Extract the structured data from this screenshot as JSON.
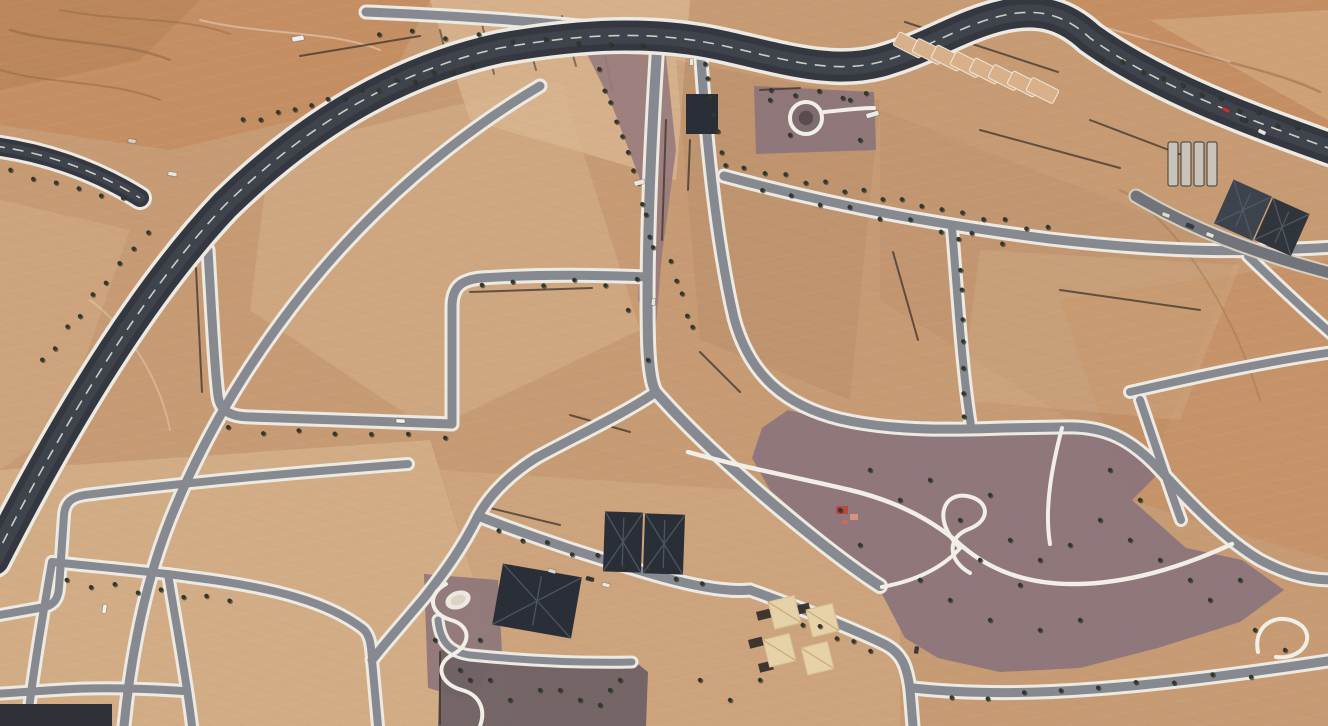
{
  "meta": {
    "description": "Aerial satellite view of a desert residential development: a wide dark asphalt boulevard arcs across the image, gray residential streets with white sidewalks divide empty tan sand plots, mauve landscaped parks with winding white footpaths and small trees fill the southeast, with a few dark-roofed buildings, beige tents and construction traces.",
    "view_type": "satellite-imagery"
  },
  "palette": {
    "sand_base": "#c79a72",
    "sand_light": "#dcba92",
    "sand_pale": "#e8cda6",
    "sand_orange": "#c4804f",
    "sand_dark": "#ae8160",
    "park_mauve": "#8b7379",
    "park_dark": "#6e5f63",
    "median_mauve": "#97797c",
    "asphalt_major": "#31343d",
    "asphalt_wear": "#4a4f59",
    "asphalt_street": "#85888f",
    "asphalt_street_dark": "#6f7278",
    "sidewalk": "#eeebe3",
    "path_white": "#f3f0e8",
    "tree": "#2f3429",
    "roof_dark": "#262a33",
    "roof_ridge": "#505a68",
    "tent": "#e7d2a8",
    "mark_dark": "#8a5f3f",
    "boundary": "#3a3028"
  },
  "patches": [
    {
      "points": "0,0 430,0 380,100 170,150 0,125",
      "fill": "sand_orange",
      "opacity": 0.5
    },
    {
      "points": "0,0 200,0 140,60 0,90",
      "fill": "#a97848",
      "opacity": 0.35
    },
    {
      "points": "430,0 690,0 676,180 470,120",
      "fill": "sand_pale",
      "opacity": 0.45
    },
    {
      "points": "1010,0 1328,0 1328,160 1090,50",
      "fill": "sand_orange",
      "opacity": 0.5
    },
    {
      "points": "1150,20 1328,10 1328,120",
      "fill": "sand_pale",
      "opacity": 0.3
    },
    {
      "points": "270,150 560,80 640,330 430,430 250,310",
      "fill": "sand_light",
      "opacity": 0.4
    },
    {
      "points": "676,60 880,100 850,400 700,340",
      "fill": "sand_dark",
      "opacity": 0.28
    },
    {
      "points": "880,110 1240,250 1150,470 880,300",
      "fill": "sand_dark",
      "opacity": 0.18
    },
    {
      "points": "1060,300 1328,260 1328,560 1130,500",
      "fill": "sand_orange",
      "opacity": 0.3
    },
    {
      "points": "0,470 430,440 520,726 0,726",
      "fill": "sand_pale",
      "opacity": 0.35
    },
    {
      "points": "440,470 900,500 900,726 520,726",
      "fill": "sand_light",
      "opacity": 0.3
    },
    {
      "points": "0,200 130,230 60,430 0,470",
      "fill": "sand_light",
      "opacity": 0.3
    },
    {
      "points": "980,250 1240,265 1180,420 960,400",
      "fill": "sand_light",
      "opacity": 0.25
    }
  ],
  "terrain_marks": [
    {
      "d": "M 10,30 C 60,45 120,40 170,60",
      "color": "mark_dark",
      "width": 2.5,
      "opacity": 0.5
    },
    {
      "d": "M 0,70 C 50,85 110,80 160,100",
      "color": "mark_dark",
      "width": 2,
      "opacity": 0.45
    },
    {
      "d": "M 60,10 C 120,22 180,16 230,34",
      "color": "mark_dark",
      "width": 2,
      "opacity": 0.4
    },
    {
      "d": "M 200,20 C 260,35 330,30 380,50",
      "color": "#f0e4d2",
      "width": 2,
      "opacity": 0.45
    },
    {
      "d": "M 380,95 C 480,62 580,42 660,42",
      "color": "boundary",
      "width": 2,
      "opacity": 0.6
    },
    {
      "d": "M 440,30 L 452,80",
      "color": "boundary",
      "width": 2,
      "opacity": 0.55
    },
    {
      "d": "M 482,24 L 494,74",
      "color": "boundary",
      "width": 2,
      "opacity": 0.55
    },
    {
      "d": "M 522,20 L 536,70",
      "color": "boundary",
      "width": 2,
      "opacity": 0.55
    },
    {
      "d": "M 562,16 L 576,66",
      "color": "boundary",
      "width": 2,
      "opacity": 0.55
    },
    {
      "d": "M 602,40 L 612,90",
      "color": "boundary",
      "width": 2,
      "opacity": 0.55
    },
    {
      "d": "M 1150,40 C 1220,62 1280,72 1320,92",
      "color": "mark_dark",
      "width": 2.5,
      "opacity": 0.45
    },
    {
      "d": "M 1080,20 C 1130,36 1180,46 1230,62",
      "color": "#f0e4d2",
      "width": 2,
      "opacity": 0.4
    },
    {
      "d": "M 1120,190 C 1170,215 1230,300 1260,400",
      "color": "mark_dark",
      "width": 2,
      "opacity": 0.3
    },
    {
      "d": "M 90,300 C 130,330 160,380 170,430",
      "color": "#f0e4d2",
      "width": 2,
      "opacity": 0.35
    }
  ],
  "parks": [
    {
      "name": "center-median",
      "points": "586,52 666,56 676,150 662,255 655,335 638,300 644,190 610,100",
      "fill": "median_mauve",
      "opacity": 0.9
    },
    {
      "name": "roundabout-plot",
      "points": "754,86 874,92 876,150 756,154",
      "fill": "park_mauve",
      "opacity": 0.95
    },
    {
      "name": "southeast-park",
      "points": "788,410 852,426 952,434 1062,428 1108,436 1160,472 1132,500 1186,548 1242,560 1284,590 1240,622 1158,648 1080,668 1000,672 938,658 905,638 880,590 828,540 770,490 752,458 762,428",
      "fill": "park_mauve",
      "opacity": 0.95
    },
    {
      "name": "pond-park",
      "points": "424,574 498,580 502,652 470,700 428,688",
      "fill": "park_mauve",
      "opacity": 0.9
    },
    {
      "name": "courtyard",
      "points": "440,650 630,658 648,672 646,726 438,726",
      "fill": "park_dark",
      "opacity": 0.95
    }
  ],
  "roads_major": [
    {
      "name": "main-boulevard",
      "d": "M -6,560 C 60,430 140,295 225,205 C 310,122 400,70 500,48 C 580,34 650,30 720,45 C 780,58 830,75 880,62 C 930,48 960,25 1005,15 C 1040,8 1065,15 1090,38 C 1160,88 1250,120 1334,150",
      "width": 30,
      "casing": 37,
      "dash": true
    },
    {
      "name": "west-access-road",
      "d": "M -6,146 C 40,152 92,168 140,198",
      "width": 18,
      "casing": 24,
      "dash": true
    }
  ],
  "roads_minor": [
    {
      "name": "northeast-service-road",
      "d": "M 1136,196 C 1190,228 1250,252 1334,274",
      "width": 11,
      "casing": 15
    }
  ],
  "streets": [
    {
      "name": "top-street",
      "d": "M 366,12 C 470,16 570,24 658,34",
      "w": 9
    },
    {
      "name": "central-vertical",
      "d": "M 658,34 C 651,140 646,250 648,340 C 649,370 652,386 656,392",
      "w": 10
    },
    {
      "name": "southeast-diagonal",
      "d": "M 656,392 C 684,424 722,460 766,498 C 812,537 852,568 880,586",
      "w": 10
    },
    {
      "name": "southwest-diagonal",
      "d": "M 656,392 C 624,414 576,436 536,458 C 506,477 488,498 478,516",
      "w": 9
    },
    {
      "name": "southwest-continuation",
      "d": "M 478,516 C 462,548 444,573 424,598 C 404,622 386,642 372,660",
      "w": 9
    },
    {
      "name": "below-villas",
      "d": "M 478,516 C 540,540 602,560 662,577 C 702,588 732,592 750,590",
      "w": 9
    },
    {
      "name": "tents-wrap",
      "d": "M 750,590 C 800,608 850,628 882,643 C 902,652 907,666 910,690 L 913,726",
      "w": 9
    },
    {
      "name": "park-south-street",
      "d": "M 913,688 C 1020,700 1150,688 1334,660",
      "w": 9
    },
    {
      "name": "median-east-street",
      "d": "M 700,44 C 706,140 716,240 734,318 C 750,378 788,406 840,419 C 892,431 950,430 1004,428 L 1062,427",
      "w": 9
    },
    {
      "name": "park-east-street",
      "d": "M 1062,427 C 1106,425 1132,440 1160,470 C 1192,505 1226,540 1260,560 C 1292,577 1312,580 1334,580",
      "w": 9
    },
    {
      "name": "northeast-mid-street",
      "d": "M 724,176 C 850,210 950,226 1050,239 C 1180,254 1252,252 1334,247",
      "w": 9
    },
    {
      "name": "northeast-vertical",
      "d": "M 952,228 C 958,300 962,370 971,426",
      "w": 8
    },
    {
      "name": "northeast-corner",
      "d": "M 1248,256 C 1285,292 1311,316 1334,336",
      "w": 8
    },
    {
      "name": "east-horizontal",
      "d": "M 1130,392 C 1200,376 1270,361 1334,352",
      "w": 8
    },
    {
      "name": "east-vertical",
      "d": "M 1140,400 C 1155,444 1168,484 1181,520",
      "w": 8
    },
    {
      "name": "inner-arc-street",
      "d": "M 540,86 C 452,138 372,208 307,288 C 247,363 202,440 170,520 C 147,578 132,645 124,726",
      "w": 9
    },
    {
      "name": "northwest-u-street",
      "d": "M 208,250 C 212,320 215,372 218,396 C 220,412 232,417 252,417 L 452,424",
      "w": 9
    },
    {
      "name": "northwest-hook",
      "d": "M 452,424 L 452,307 C 452,286 462,280 481,278 C 540,274 600,275 648,277",
      "w": 9
    },
    {
      "name": "southwest-top-street",
      "d": "M -6,616 L 45,607 C 55,604 58,598 59,588 L 64,515 C 65,502 72,497 85,495 C 190,482 300,472 408,464",
      "w": 8
    },
    {
      "name": "southwest-v1",
      "d": "M 52,562 C 42,620 33,672 27,726",
      "w": 8
    },
    {
      "name": "southwest-h2",
      "d": "M 52,562 C 110,568 165,573 190,577 C 280,588 330,604 362,628 C 370,634 371,645 372,658",
      "w": 8
    },
    {
      "name": "southwest-v4",
      "d": "M 372,660 L 378,726",
      "w": 8
    },
    {
      "name": "southwest-v2",
      "d": "M 168,574 C 176,624 186,676 192,726",
      "w": 8
    },
    {
      "name": "southwest-h3",
      "d": "M -6,694 L 55,690 C 100,687 140,688 183,691",
      "w": 8
    },
    {
      "name": "courtyard-top-lane",
      "d": "M 438,620 C 440,640 448,652 470,655 C 530,661 585,663 632,662",
      "w": 7
    }
  ],
  "paths": [
    {
      "name": "park-main-path",
      "d": "M 688,452 C 745,468 800,478 850,490 C 900,502 935,522 962,546 C 992,572 1030,585 1078,584 C 1128,583 1180,568 1232,544",
      "w": 4.5
    },
    {
      "name": "park-loop-path",
      "d": "M 958,546 C 932,518 944,492 967,496 C 989,500 992,520 969,529 C 947,537 947,560 970,573",
      "w": 4
    },
    {
      "name": "park-north-link",
      "d": "M 1062,428 C 1052,466 1044,508 1050,544",
      "w": 4
    },
    {
      "name": "park-west-link",
      "d": "M 882,587 C 920,580 945,566 962,546",
      "w": 4
    },
    {
      "name": "park-east-blob",
      "d": "M 1258,652 C 1252,622 1282,610 1302,626 C 1316,640 1300,660 1276,657",
      "w": 4
    },
    {
      "name": "pond-path",
      "d": "M 446,584 C 426,595 430,614 451,620 C 472,626 471,645 452,655 C 434,665 440,684 462,690 C 480,695 486,710 480,726",
      "w": 4
    },
    {
      "name": "roundabout-stub",
      "d": "M 824,112 C 845,110 858,108 874,108",
      "w": 4
    }
  ],
  "boundaries": [
    "M 470,292 L 592,288",
    "M 666,120 L 662,240",
    "M 905,22 L 1058,72",
    "M 760,90 L 800,88",
    "M 690,140 L 688,190",
    "M 570,415 L 630,432",
    "M 196,268 L 202,392",
    "M 300,56 L 420,36",
    "M 893,252 L 918,340",
    "M 980,130 L 1120,168",
    "M 1060,290 L 1200,310",
    "M 490,508 L 560,525",
    "M 440,652 L 440,724",
    "M 700,352 L 740,392",
    "M 1090,120 L 1190,158",
    "M 240,418 L 300,420"
  ],
  "tree_lines": [
    [
      240,
      122,
      470,
      66,
      14
    ],
    [
      40,
      362,
      150,
      232,
      9
    ],
    [
      602,
      72,
      654,
      250,
      12
    ],
    [
      668,
      262,
      694,
      330,
      5
    ],
    [
      742,
      168,
      1046,
      230,
      16
    ],
    [
      764,
      190,
      1000,
      242,
      9
    ],
    [
      708,
      62,
      724,
      168,
      7
    ],
    [
      1100,
      56,
      1300,
      130,
      11
    ],
    [
      382,
      32,
      640,
      46,
      9
    ],
    [
      956,
      242,
      966,
      418,
      8
    ],
    [
      12,
      172,
      120,
      200,
      6
    ],
    [
      64,
      582,
      232,
      600,
      8
    ],
    [
      500,
      532,
      700,
      584,
      9
    ],
    [
      952,
      700,
      1250,
      674,
      9
    ],
    [
      800,
      622,
      872,
      650,
      5
    ],
    [
      768,
      92,
      866,
      96,
      5
    ],
    [
      230,
      430,
      445,
      436,
      7
    ],
    [
      480,
      284,
      640,
      282,
      6
    ]
  ],
  "tree_scatter": [
    [
      870,
      470
    ],
    [
      900,
      500
    ],
    [
      930,
      480
    ],
    [
      960,
      520
    ],
    [
      990,
      495
    ],
    [
      1010,
      540
    ],
    [
      1040,
      560
    ],
    [
      1070,
      545
    ],
    [
      1100,
      520
    ],
    [
      1130,
      540
    ],
    [
      1160,
      560
    ],
    [
      1190,
      580
    ],
    [
      1080,
      620
    ],
    [
      1040,
      630
    ],
    [
      990,
      620
    ],
    [
      950,
      600
    ],
    [
      920,
      580
    ],
    [
      1210,
      600
    ],
    [
      1240,
      580
    ],
    [
      860,
      545
    ],
    [
      840,
      510
    ],
    [
      1110,
      470
    ],
    [
      1140,
      500
    ],
    [
      980,
      560
    ],
    [
      1020,
      585
    ],
    [
      1255,
      630
    ],
    [
      1285,
      650
    ],
    [
      700,
      680
    ],
    [
      730,
      700
    ],
    [
      760,
      680
    ],
    [
      540,
      690
    ],
    [
      580,
      700
    ],
    [
      490,
      680
    ],
    [
      460,
      670
    ],
    [
      610,
      690
    ],
    [
      470,
      680
    ],
    [
      510,
      700
    ],
    [
      560,
      690
    ],
    [
      600,
      705
    ],
    [
      620,
      680
    ],
    [
      770,
      100
    ],
    [
      790,
      135
    ],
    [
      850,
      100
    ],
    [
      860,
      140
    ],
    [
      435,
      640
    ],
    [
      480,
      640
    ],
    [
      628,
      310
    ],
    [
      648,
      360
    ]
  ],
  "buildings": [
    {
      "name": "villa-roof-a1",
      "x": 604,
      "y": 512,
      "w": 38,
      "h": 60,
      "rot": 2,
      "fill": "roof_dark",
      "ridge": true
    },
    {
      "name": "villa-roof-a2",
      "x": 644,
      "y": 514,
      "w": 40,
      "h": 60,
      "rot": 2,
      "fill": "roof_dark",
      "ridge": true
    },
    {
      "name": "villa-roof-b",
      "x": 497,
      "y": 570,
      "w": 80,
      "h": 62,
      "rot": 10,
      "fill": "roof_dark",
      "ridge": true
    },
    {
      "name": "warehouse-roof-c1",
      "x": 1222,
      "y": 186,
      "w": 42,
      "h": 48,
      "rot": 24,
      "fill": "#3a4049",
      "ridge": true
    },
    {
      "name": "warehouse-roof-c2",
      "x": 1262,
      "y": 204,
      "w": 40,
      "h": 46,
      "rot": 24,
      "fill": "#2c3138",
      "ridge": true
    },
    {
      "name": "edge-building-south",
      "x": 0,
      "y": 704,
      "w": 112,
      "h": 22,
      "rot": 0,
      "fill": "#2b2e35",
      "ridge": false
    },
    {
      "name": "small-dark-building",
      "x": 686,
      "y": 94,
      "w": 32,
      "h": 40,
      "rot": 0,
      "fill": "roof_dark",
      "ridge": false
    }
  ],
  "lot_rows": [
    {
      "name": "boulevard-lot-row",
      "x": 902,
      "y": 30,
      "dx": 19,
      "dy": 6.5,
      "n": 8,
      "w": 15,
      "h": 30,
      "rot": -63,
      "fill": "#d9b088",
      "stroke": "#f0eadf"
    },
    {
      "name": "construction-lot-row",
      "x": 1168,
      "y": 142,
      "dx": 13,
      "dy": 0,
      "n": 4,
      "w": 10,
      "h": 44,
      "rot": 0,
      "fill": "#c9c3ba",
      "stroke": "#3a3730"
    }
  ],
  "tents": [
    [
      768,
      602
    ],
    [
      806,
      610
    ],
    [
      763,
      640
    ],
    [
      801,
      648
    ]
  ],
  "tent_shadows": [
    [
      756,
      612
    ],
    [
      748,
      640
    ],
    [
      758,
      664
    ],
    [
      795,
      606
    ]
  ],
  "red_bits": [
    [
      836,
      506,
      12,
      8,
      "#b8463f"
    ],
    [
      850,
      514,
      8,
      6,
      "#d98f7f"
    ],
    [
      842,
      520,
      6,
      4,
      "#c96a58"
    ]
  ],
  "roundabout": {
    "cx": 806,
    "cy": 118,
    "r": 16
  },
  "pond": {
    "cx": 458,
    "cy": 600,
    "rx": 13,
    "ry": 9,
    "rot": -20
  },
  "cars": [
    [
      292,
      36,
      12,
      5,
      "#f2f1ec",
      -10
    ],
    [
      168,
      172,
      9,
      4,
      "#e8e6e0",
      10
    ],
    [
      128,
      139,
      8,
      4,
      "#d5d2c9",
      10
    ],
    [
      396,
      419,
      9,
      4,
      "#f3f2ec",
      3
    ],
    [
      100,
      607,
      9,
      4,
      "#f6f5ef",
      -80
    ],
    [
      634,
      180,
      11,
      5,
      "#e9e7de",
      -15
    ],
    [
      866,
      112,
      13,
      5,
      "#edebe3",
      -16
    ],
    [
      1240,
      118,
      8,
      4,
      "#2e3238",
      26
    ],
    [
      1258,
      130,
      8,
      4,
      "#e8e6df",
      26
    ],
    [
      1222,
      108,
      8,
      4,
      "#b5342c",
      26
    ],
    [
      586,
      577,
      8,
      4,
      "#2f333a",
      16
    ],
    [
      602,
      583,
      8,
      4,
      "#e9e7e0",
      16
    ],
    [
      548,
      569,
      8,
      4,
      "#d9d6cd",
      16
    ],
    [
      1162,
      213,
      8,
      4,
      "#dedbd2",
      22
    ],
    [
      1186,
      224,
      8,
      4,
      "#33373e",
      22
    ],
    [
      1206,
      233,
      8,
      4,
      "#e6e3da",
      22
    ],
    [
      650,
      300,
      7,
      4,
      "#e8e5dc",
      -85
    ],
    [
      913,
      648,
      7,
      4,
      "#33373d",
      -80
    ],
    [
      688,
      60,
      7,
      4,
      "#eae8e0",
      -85
    ]
  ]
}
